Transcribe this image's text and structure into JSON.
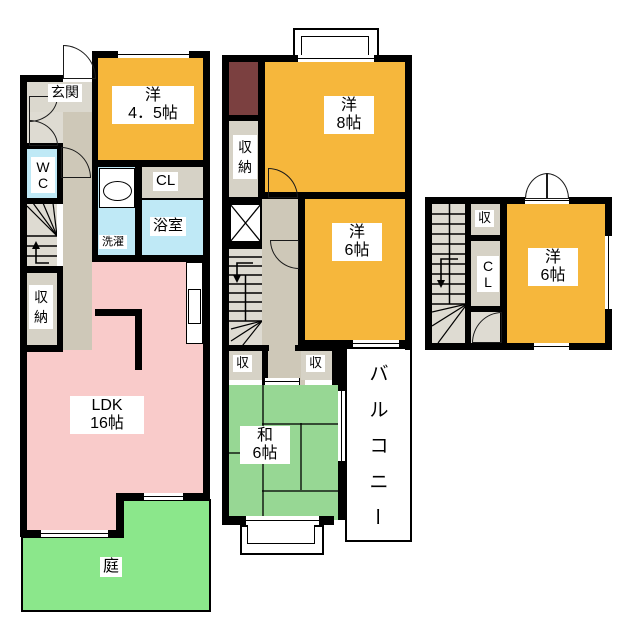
{
  "title": "間取り図",
  "floor1": {
    "entrance": "玄関",
    "room45": [
      "洋",
      "4．5帖"
    ],
    "wc": [
      "W",
      "C"
    ],
    "cl": "CL",
    "bath": "浴室",
    "laundry": "洗濯",
    "storage": [
      "収",
      "納"
    ],
    "ldk": [
      "LDK",
      "16帖"
    ],
    "garden": "庭"
  },
  "floor2": {
    "room8": [
      "洋",
      "8帖"
    ],
    "storage": [
      "収",
      "納"
    ],
    "room6": [
      "洋",
      "6帖"
    ],
    "storage_small_left": "収",
    "storage_small_right": "収",
    "washitsu": [
      "和",
      "6帖"
    ],
    "balcony": [
      "バ",
      "ル",
      "コ",
      "ニ",
      "ー"
    ]
  },
  "floor3": {
    "storage_small": "収",
    "cl": [
      "C",
      "L"
    ],
    "room6": [
      "洋",
      "6帖"
    ]
  },
  "colors": {
    "wall": "#000000",
    "western_room": "#F6B73C",
    "ldk_pink": "#F9CBCA",
    "tatami_green": "#97D794",
    "garden_green": "#8BE78B",
    "water_blue": "#BFE9F6",
    "hall_beige": "#CEC8B8",
    "entrance_gray": "#DBD8CE",
    "closet_gray": "#D6D2C6",
    "accent_maroon": "#7B4040"
  }
}
